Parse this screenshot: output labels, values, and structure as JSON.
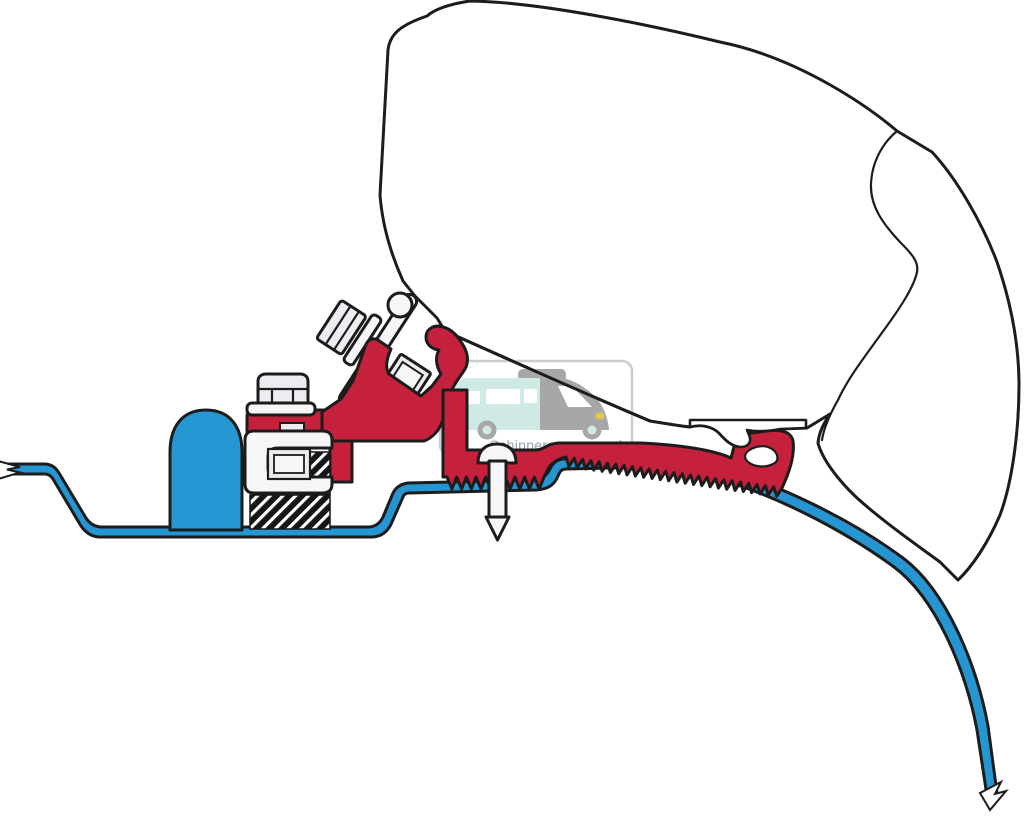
{
  "watermark": {
    "text": "Schippercaravans.nl"
  },
  "colors": {
    "page_bg": "#ffffff",
    "profile_red": "#c5203c",
    "roof_blue": "#2596d1",
    "outline": "#1c1c1c",
    "hardware_gray": "#ededf1",
    "wm_border": "#cccccc",
    "wm_teal": "#cfe9e4",
    "wm_gray": "#a7a7a7",
    "wm_textcol": "#9aa3a3",
    "headlight_yellow": "#e8c84a"
  }
}
